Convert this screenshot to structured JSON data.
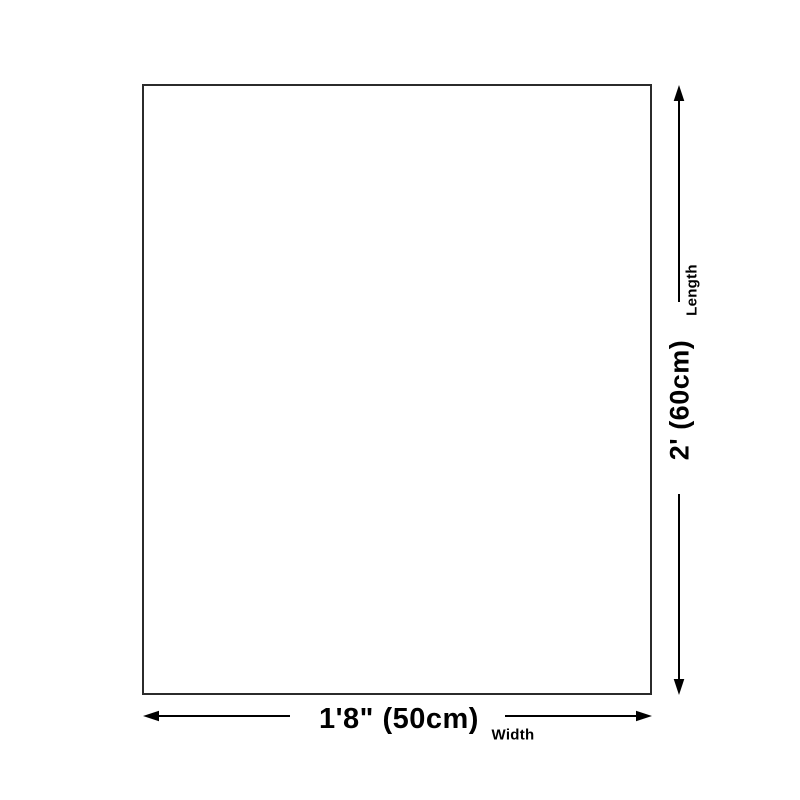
{
  "diagram": {
    "type": "product-dimension-diagram",
    "length": {
      "label": "Length",
      "value": "2' (60cm)"
    },
    "width": {
      "label": "Width",
      "value": "1'8\" (50cm)"
    },
    "colors": {
      "background": "#ffffff",
      "outline": "#2b2b2b",
      "line": "#000000",
      "text": "#000000"
    }
  }
}
